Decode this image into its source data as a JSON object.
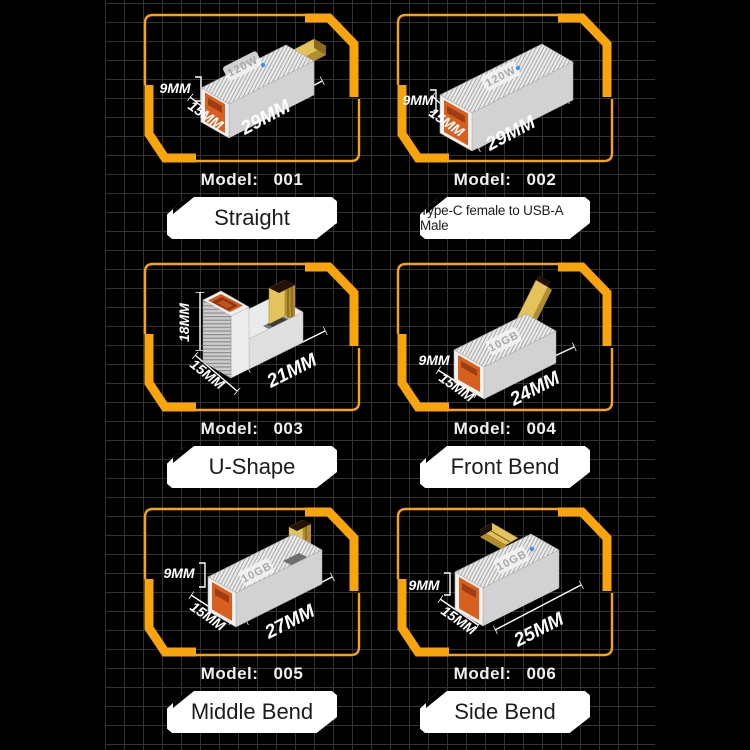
{
  "page": {
    "background": "#000000",
    "grid_color": "#333333",
    "accent_color": "#F9A40B",
    "port_color": "#D95F1F",
    "gold_color": "#DFBE55",
    "led_color": "#3D8BFF"
  },
  "panels": [
    {
      "model_label": "Model:",
      "model_value": "001",
      "shape_name": "Straight",
      "top_text": "120W",
      "dims": {
        "height": "9MM",
        "width": "15MM",
        "length": "29MM"
      }
    },
    {
      "model_label": "Model:",
      "model_value": "002",
      "shape_name": "Type-C female to USB-A Male",
      "top_text": "120W",
      "dims": {
        "height": "9MM",
        "width": "15MM",
        "length": "29MM"
      }
    },
    {
      "model_label": "Model:",
      "model_value": "003",
      "shape_name": "U-Shape",
      "top_text": "",
      "dims": {
        "height": "18MM",
        "width": "15MM",
        "length": "21MM"
      }
    },
    {
      "model_label": "Model:",
      "model_value": "004",
      "shape_name": "Front Bend",
      "top_text": "10GB",
      "dims": {
        "height": "9MM",
        "width": "15MM",
        "length": "24MM"
      }
    },
    {
      "model_label": "Model:",
      "model_value": "005",
      "shape_name": "Middle Bend",
      "top_text": "10GB",
      "dims": {
        "height": "9MM",
        "width": "15MM",
        "length": "27MM"
      }
    },
    {
      "model_label": "Model:",
      "model_value": "006",
      "shape_name": "Side Bend",
      "top_text": "10GB",
      "dims": {
        "height": "9MM",
        "width": "15MM",
        "length": "25MM"
      }
    }
  ]
}
